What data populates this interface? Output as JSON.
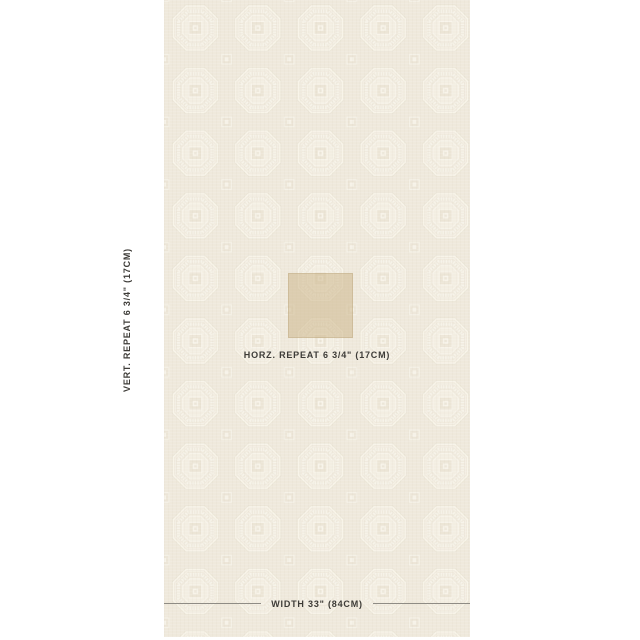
{
  "page": {
    "background": "#ffffff"
  },
  "swatch": {
    "annotations": {
      "vertical_repeat": "VERT. REPEAT 6 3/4\" (17CM)",
      "horizontal_repeat": "HORZ. REPEAT 6 3/4\" (17CM)",
      "width": "WIDTH 33\" (84CM)"
    },
    "colors": {
      "fabric_base": "#efe9dc",
      "pattern_light": "#f8f4ea",
      "pattern_mid": "#f3eee2",
      "pattern_shadow": "#e4ddcd",
      "motif_fill": "#ece5d6",
      "repeat_highlight": "rgba(203,180,137,0.52)",
      "annotation_text": "#3d3b37",
      "annotation_line": "#8f8c85"
    },
    "pattern": {
      "tile_size_px": 62.6,
      "motif": "octagon-medallion"
    }
  }
}
